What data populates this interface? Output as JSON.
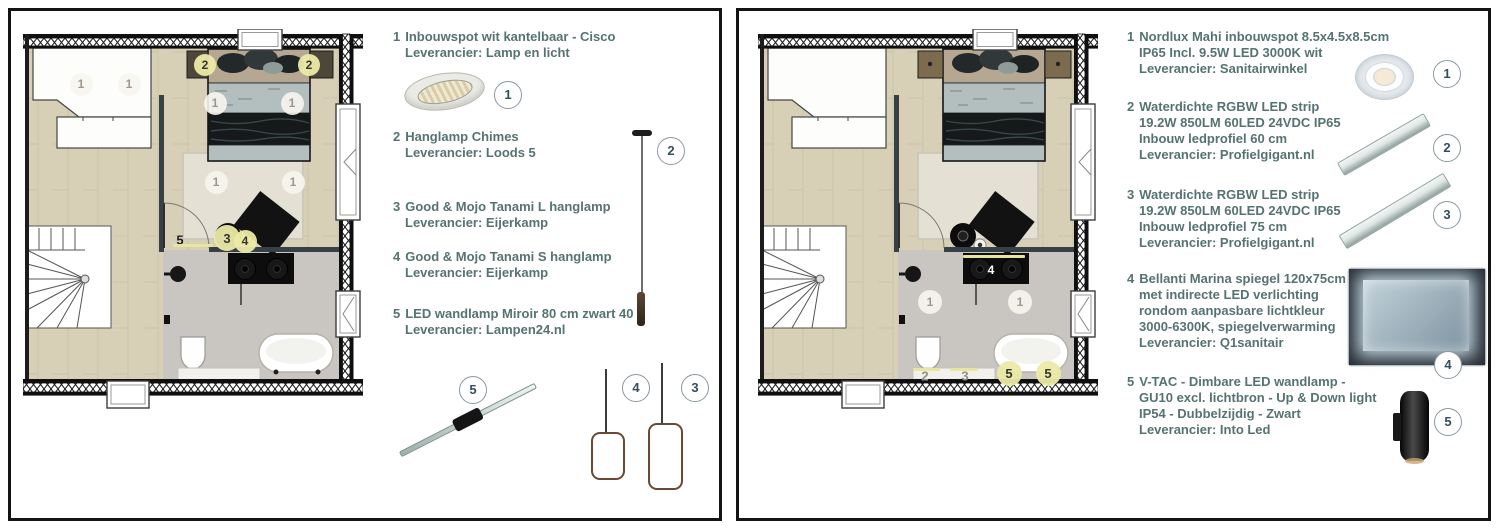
{
  "colors": {
    "legend_text": "#577272",
    "marker_yellow": "#ece9a6",
    "marker_white": "#f5f3ec",
    "floor_wood": "#d8d0b6",
    "floor_bath": "#c9c5c0",
    "wall": "#141414"
  },
  "panels": [
    {
      "side": "left",
      "legend": [
        {
          "num": "1",
          "title": "Inbouwspot wit kantelbaar - Cisco",
          "details": [
            "Leverancier: Lamp en licht"
          ]
        },
        {
          "num": "2",
          "title": "Hanglamp Chimes",
          "details": [
            "Leverancier: Loods 5"
          ]
        },
        {
          "num": "3",
          "title": "Good & Mojo Tanami L hanglamp",
          "details": [
            "Leverancier: Eijerkamp"
          ]
        },
        {
          "num": "4",
          "title": "Good & Mojo Tanami S hanglamp",
          "details": [
            "Leverancier: Eijerkamp"
          ]
        },
        {
          "num": "5",
          "title": "LED wandlamp Miroir 80 cm zwart 4000",
          "details": [
            "Leverancier: Lampen24.nl"
          ]
        }
      ],
      "plan": {
        "markers": [
          {
            "t": "w",
            "label": "1",
            "x": 58,
            "y": 55,
            "d": 23
          },
          {
            "t": "w",
            "label": "1",
            "x": 106,
            "y": 55,
            "d": 23
          },
          {
            "t": "y",
            "label": "2",
            "x": 182,
            "y": 36,
            "d": 22
          },
          {
            "t": "y",
            "label": "2",
            "x": 286,
            "y": 36,
            "d": 22
          },
          {
            "t": "w",
            "label": "1",
            "x": 192,
            "y": 74,
            "d": 23
          },
          {
            "t": "w",
            "label": "1",
            "x": 269,
            "y": 74,
            "d": 23
          },
          {
            "t": "w",
            "label": "1",
            "x": 193,
            "y": 153,
            "d": 23
          },
          {
            "t": "w",
            "label": "1",
            "x": 270,
            "y": 153,
            "d": 23
          },
          {
            "t": "y",
            "label": "3",
            "x": 204,
            "y": 209,
            "d": 26
          },
          {
            "t": "y",
            "label": "4",
            "x": 222,
            "y": 212,
            "d": 23
          },
          {
            "t": "txt",
            "label": "5",
            "x": 157,
            "y": 211,
            "c": "#1f1f1f"
          }
        ],
        "strips": [
          {
            "x": 150,
            "y": 215,
            "w": 40
          }
        ]
      }
    },
    {
      "side": "right",
      "legend": [
        {
          "num": "1",
          "title": "Nordlux Mahi inbouwspot 8.5x4.5x8.5cm",
          "details": [
            "IP65 Incl. 9.5W LED 3000K wit",
            "Leverancier: Sanitairwinkel"
          ]
        },
        {
          "num": "2",
          "title": "Waterdichte RGBW LED strip",
          "details": [
            "19.2W 850LM 60LED 24VDC IP65",
            "Inbouw ledprofiel 60 cm",
            "Leverancier: Profielgigant.nl"
          ]
        },
        {
          "num": "3",
          "title": "Waterdichte RGBW LED strip",
          "details": [
            "19.2W 850LM 60LED 24VDC IP65",
            "Inbouw ledprofiel 75 cm",
            "Leverancier: Profielgigant.nl"
          ]
        },
        {
          "num": "4",
          "title": "Bellanti Marina spiegel 120x75cm",
          "details": [
            "met indirecte LED verlichting",
            "rondom aanpasbare lichtkleur",
            "3000-6300K, spiegelverwarming",
            "Leverancier: Q1sanitair"
          ]
        },
        {
          "num": "5",
          "title": "V-TAC - Dimbare LED wandlamp -",
          "details": [
            "GU10 excl. lichtbron - Up & Down light",
            "IP54 - Dubbelzijdig - Zwart",
            "Leverancier: Into Led"
          ]
        }
      ],
      "plan": {
        "markers": [
          {
            "t": "w",
            "label": "1",
            "x": 172,
            "y": 273,
            "d": 24
          },
          {
            "t": "w",
            "label": "1",
            "x": 262,
            "y": 273,
            "d": 24
          },
          {
            "t": "txtw",
            "label": "4",
            "x": 233,
            "y": 241
          },
          {
            "t": "txt",
            "label": "2",
            "x": 167,
            "y": 347,
            "c": "#8e8e84"
          },
          {
            "t": "txt",
            "label": "3",
            "x": 207,
            "y": 347,
            "c": "#8e8e84"
          },
          {
            "t": "y",
            "label": "5",
            "x": 251,
            "y": 344,
            "d": 25
          },
          {
            "t": "y",
            "label": "5",
            "x": 290,
            "y": 344,
            "d": 25
          }
        ],
        "strips": [
          {
            "x": 205,
            "y": 226,
            "w": 62
          },
          {
            "x": 155,
            "y": 339,
            "w": 27
          },
          {
            "x": 192,
            "y": 339,
            "w": 28
          }
        ]
      }
    }
  ]
}
